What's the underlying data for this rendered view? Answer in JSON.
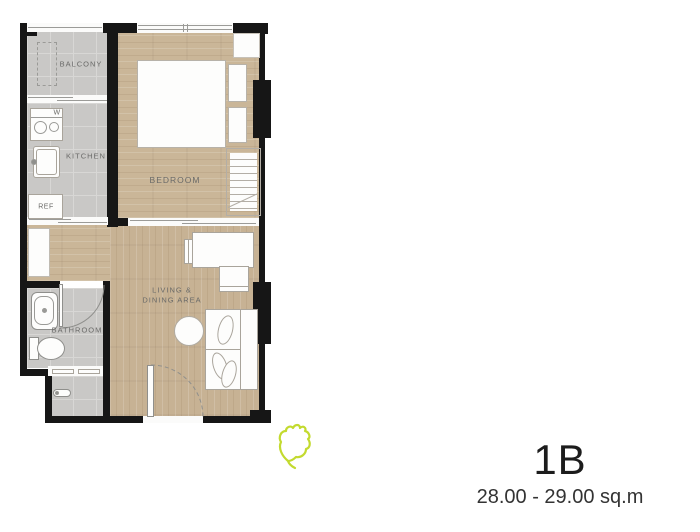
{
  "plan": {
    "rooms": {
      "balcony": "BALCONY",
      "kitchen": "KITCHEN",
      "bedroom": "BEDROOM",
      "bathroom": "BATHROOM",
      "living_line1": "LIVING &",
      "living_line2": "DINING AREA"
    },
    "appliances": {
      "washer": "W",
      "fridge": "REF"
    },
    "colors": {
      "wall": "#161616",
      "tile_floor": "#c9c8c6",
      "wood_floor": "#cab698",
      "leaf_accent": "#c3da2f"
    },
    "icons": [
      "leaf-icon"
    ]
  },
  "unit": {
    "name": "1B",
    "area": "28.00 - 29.00 sq.m"
  }
}
